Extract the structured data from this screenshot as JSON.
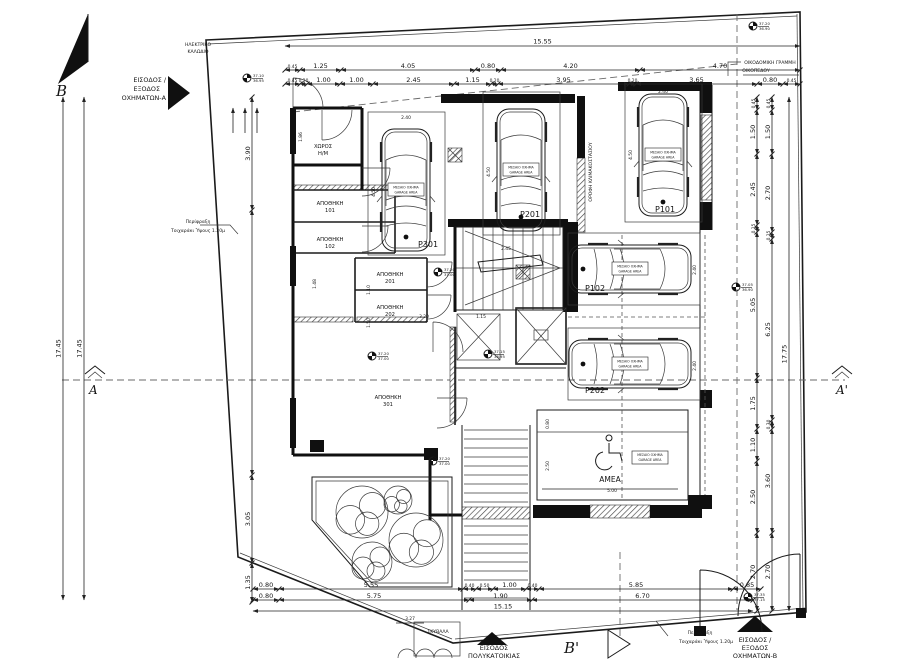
{
  "colors": {
    "ink": "#1b1b1b",
    "dash": "#6a6a6a",
    "paper": "#ffffff"
  },
  "markers": {
    "north": "B",
    "section_b2": "Β'",
    "section_a": "A",
    "section_a2": "A'"
  },
  "entrances": {
    "vehicles_a": {
      "lines": [
        "ΕΙΣΟΔΟΣ /",
        "ΕΞΟΔΟΣ",
        "ΟΧΗΜΑΤΩΝ-Α"
      ]
    },
    "vehicles_b": {
      "lines": [
        "ΕΙΣΟΔΟΣ /",
        "ΕΞΟΔΟΣ",
        "ΟΧΗΜΑΤΩΝ-Β"
      ]
    },
    "building": {
      "lines": [
        "ΕΙΣΟΔΟΣ",
        "ΠΟΛΥΚΑΤΟΙΚΙΑΣ"
      ]
    }
  },
  "notes": {
    "building_line": {
      "lines": [
        "ΟΙΚΟΔΟΜΙΚΗ ΓΡΑΜΜΗ",
        "ΟΙΚΟΠΕΔΟΥ"
      ]
    },
    "fence_left": {
      "lines": [
        "Περίφραξη",
        "Τοιχαράκι Ύψους 1.20μ"
      ]
    },
    "fence_bottom": {
      "lines": [
        "Περίφραξη",
        "Τοιχαράκι Ύψους 1.20μ"
      ]
    },
    "cable": {
      "lines": [
        "ΗΛΕΚΤΡΙΚΟ",
        "ΚΑΛΩΔΙΟ"
      ]
    },
    "garbage": "ΣΚΥΒΑΛΑ",
    "stair_roof": "ΟΡΟΦΗ ΚΛΙΜΑΚΟΣΤΑΣΙΟΥ",
    "amea": "ΑΜΕΑ"
  },
  "rooms": [
    {
      "line1": "ΧΩΡΟΣ",
      "line2": "Η/Μ",
      "x": 323,
      "y": 148
    },
    {
      "line1": "ΑΠΟΘΗΚΗ",
      "line2": "101",
      "x": 330,
      "y": 205
    },
    {
      "line1": "ΑΠΟΘΗΚΗ",
      "line2": "102",
      "x": 330,
      "y": 241
    },
    {
      "line1": "ΑΠΟΘΗΚΗ",
      "line2": "201",
      "x": 390,
      "y": 276
    },
    {
      "line1": "ΑΠΟΘΗΚΗ",
      "line2": "202",
      "x": 390,
      "y": 309
    },
    {
      "line1": "ΑΠΟΘΗΚΗ",
      "line2": "301",
      "x": 388,
      "y": 399
    }
  ],
  "parking_spots": [
    {
      "id": "P301",
      "x": 418,
      "y": 247
    },
    {
      "id": "P201",
      "x": 520,
      "y": 217
    },
    {
      "id": "P101",
      "x": 655,
      "y": 212
    },
    {
      "id": "P102",
      "x": 585,
      "y": 291
    },
    {
      "id": "P202",
      "x": 585,
      "y": 393
    }
  ],
  "car_tag": {
    "line1": "ΜΕΣΑΙΟ ΟΧΗΜΑ",
    "line2": "GARAGE AREA"
  },
  "elevations": [
    {
      "x": 247,
      "y": 78,
      "a": "37.10",
      "b": "36.95"
    },
    {
      "x": 753,
      "y": 26,
      "a": "37.20",
      "b": "36.90"
    },
    {
      "x": 736,
      "y": 287,
      "a": "37.05",
      "b": "36.90"
    },
    {
      "x": 372,
      "y": 356,
      "a": "37.20",
      "b": "37.00"
    },
    {
      "x": 438,
      "y": 272,
      "a": "37.20",
      "b": "37.00"
    },
    {
      "x": 488,
      "y": 354,
      "a": "37.15",
      "b": "36.95"
    },
    {
      "x": 433,
      "y": 461,
      "a": "37.20",
      "b": "37.00"
    },
    {
      "x": 748,
      "y": 597,
      "a": "37.35",
      "b": "37.15"
    }
  ],
  "dimensions": {
    "totals": [
      {
        "label": "15.55",
        "o": "h",
        "y": 46,
        "x1": 285,
        "x2": 800
      },
      {
        "label": "15.15",
        "o": "h",
        "y": 611,
        "x1": 253,
        "x2": 753
      },
      {
        "label": "17.75",
        "o": "v",
        "x": 789,
        "y1": 97,
        "y2": 611
      },
      {
        "label": "17.45",
        "o": "v",
        "x": 63,
        "y1": 97,
        "y2": 600
      },
      {
        "label": "17.45",
        "o": "v",
        "x": 84,
        "y1": 97,
        "y2": 600
      }
    ],
    "chains": [
      {
        "o": "h",
        "y": 70,
        "ticks": [
          285,
          300,
          341,
          475,
          501,
          640,
          800
        ],
        "labels": [
          "0.45",
          "1.25",
          "4.05",
          "0.80",
          "4.20",
          "4.70"
        ]
      },
      {
        "o": "h",
        "y": 84,
        "ticks": [
          285,
          300,
          307,
          340,
          373,
          454,
          491,
          498,
          629,
          636,
          757,
          783,
          800
        ],
        "labels": [
          "0.45",
          "0.20",
          "1.00",
          "1.00",
          "2.45",
          "1.15",
          "0.20",
          "3.95",
          "0.20",
          "3.65",
          "0.80",
          "0.45"
        ]
      },
      {
        "o": "h",
        "y": 589,
        "ticks": [
          253,
          279,
          463,
          476,
          493,
          526,
          539,
          733,
          761
        ],
        "labels": [
          "0.80",
          "5.55",
          "0.40",
          "0.50",
          "1.00",
          "0.40",
          "5.85",
          "0.85"
        ]
      },
      {
        "o": "h",
        "y": 600,
        "ticks": [
          253,
          279,
          469,
          532,
          753
        ],
        "labels": [
          "0.80",
          "5.75",
          "1.90",
          "6.70"
        ]
      },
      {
        "o": "v",
        "x": 757,
        "ticks": [
          97,
          110,
          154,
          225,
          232,
          378,
          429,
          461,
          533,
          611
        ],
        "labels": [
          "0.45",
          "1.50",
          "2.45",
          "0.25",
          "5.05",
          "1.75",
          "1.10",
          "2.50",
          "2.70"
        ]
      },
      {
        "o": "v",
        "x": 772,
        "ticks": [
          97,
          110,
          154,
          232,
          239,
          420,
          429,
          533,
          611
        ],
        "labels": [
          "0.45",
          "1.50",
          "2.70",
          "0.25",
          "6.25",
          "0.30",
          "3.60",
          "2.70"
        ]
      },
      {
        "o": "v",
        "x": 252,
        "ticks": [
          97,
          210,
          475,
          563,
          602
        ],
        "labels": [
          "3.90",
          "",
          "3.05",
          "1.35"
        ]
      }
    ],
    "interior": [
      {
        "t": "3.20",
        "x": 424,
        "y": 318
      },
      {
        "t": "1.15",
        "x": 481,
        "y": 318
      },
      {
        "t": "2.45",
        "x": 506,
        "y": 250
      },
      {
        "t": "3.27",
        "x": 410,
        "y": 620
      },
      {
        "t": "1.48",
        "x": 316,
        "y": 284,
        "r": 1
      },
      {
        "t": "1.10",
        "x": 370,
        "y": 290,
        "r": 1
      },
      {
        "t": "1.50",
        "x": 370,
        "y": 323,
        "r": 1
      },
      {
        "t": "1.86",
        "x": 302,
        "y": 137,
        "r": 1
      },
      {
        "t": "0.80",
        "x": 549,
        "y": 424,
        "r": 1
      },
      {
        "t": "2.50",
        "x": 549,
        "y": 466,
        "r": 1
      },
      {
        "t": "5.00",
        "x": 612,
        "y": 492
      },
      {
        "t": "2.40",
        "x": 406,
        "y": 119
      },
      {
        "t": "2.40",
        "x": 521,
        "y": 101
      },
      {
        "t": "2.40",
        "x": 663,
        "y": 93
      },
      {
        "t": "2.40",
        "x": 696,
        "y": 270,
        "r": 1
      },
      {
        "t": "2.40",
        "x": 696,
        "y": 366,
        "r": 1
      },
      {
        "t": "4.50",
        "x": 375,
        "y": 192,
        "r": 1
      },
      {
        "t": "4.50",
        "x": 490,
        "y": 172,
        "r": 1
      },
      {
        "t": "4.50",
        "x": 632,
        "y": 155,
        "r": 1
      }
    ]
  }
}
